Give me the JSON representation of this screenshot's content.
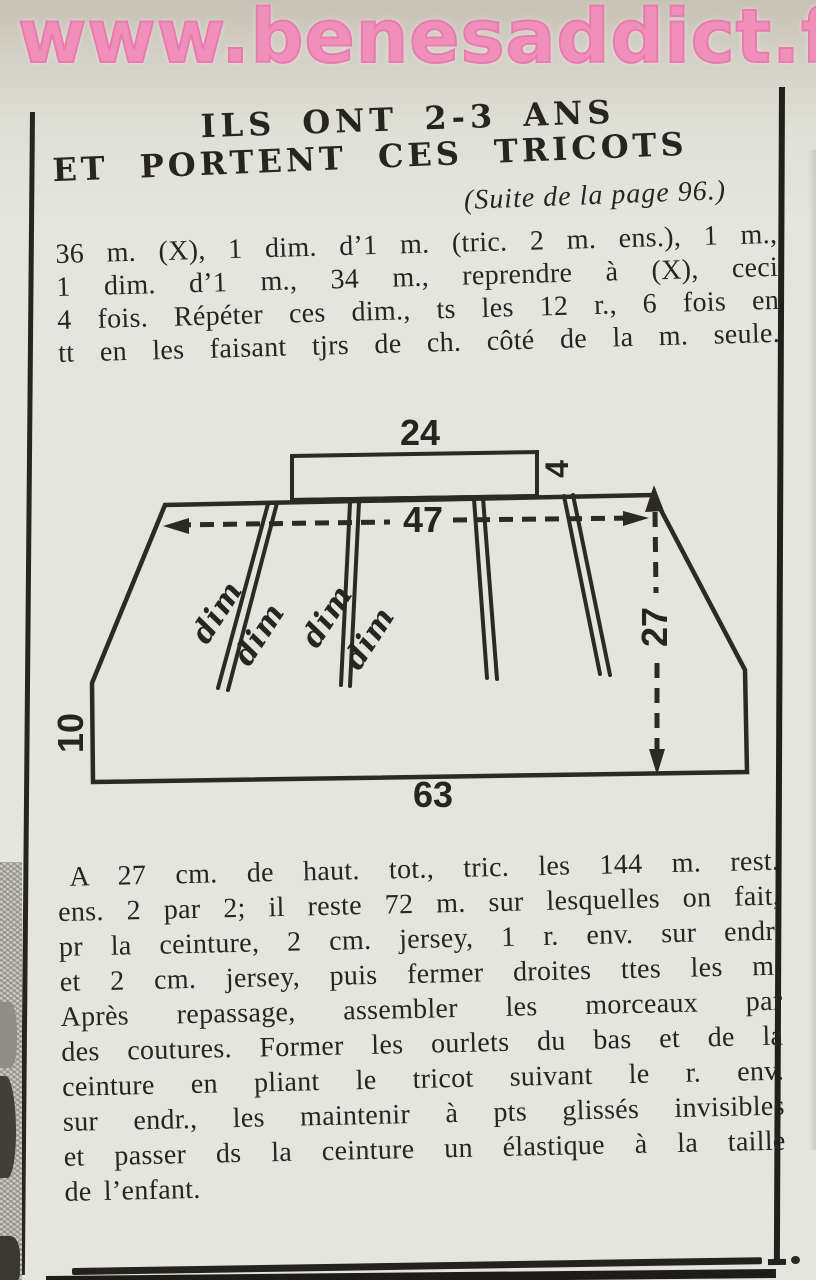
{
  "watermark": {
    "text": "www.benesaddict.fr",
    "color": "#f08fbb"
  },
  "header": {
    "title_line1": "ILS ONT 2-3 ANS",
    "title_line2": "ET PORTENT CES TRICOTS",
    "subtitle": "(Suite de la page 96.)"
  },
  "instructions": {
    "paragraph1": [
      "36 m. (X), 1 dim. d’1 m. (tric. 2 m. ens.), 1 m.,",
      "1 dim. d’1 m., 34 m., reprendre à (X), ceci",
      "4 fois. Répéter ces dim., ts les 12 r., 6 fois en",
      "tt en les faisant tjrs de ch. côté de la m. seule."
    ],
    "paragraph2": [
      "A 27 cm. de haut. tot., tric. les 144 m. rest.",
      "ens. 2 par 2; il reste 72 m. sur lesquelles on fait,",
      "pr la ceinture, 2 cm. jersey, 1 r. env. sur endr.",
      "et 2 cm. jersey, puis fermer droites ttes les m.",
      "Après repassage, assembler les morceaux par",
      "des coutures. Former les ourlets du bas et de la",
      "ceinture en pliant le tricot suivant le r. env.",
      "sur endr., les maintenir à pts glissés invisibles",
      "et passer ds la ceinture un élastique à la taille",
      "de l’enfant."
    ]
  },
  "diagram": {
    "type": "knitting-schematic-skirt-panel",
    "measurements_cm": {
      "waistband_width": "24",
      "waistband_height": "4",
      "upper_width": "47",
      "side_height": "27",
      "hem_height": "10",
      "bottom_width": "63"
    },
    "dart_labels": [
      "dim",
      "dim",
      "dim",
      "dim"
    ],
    "ink_color": "#2b2a24"
  }
}
